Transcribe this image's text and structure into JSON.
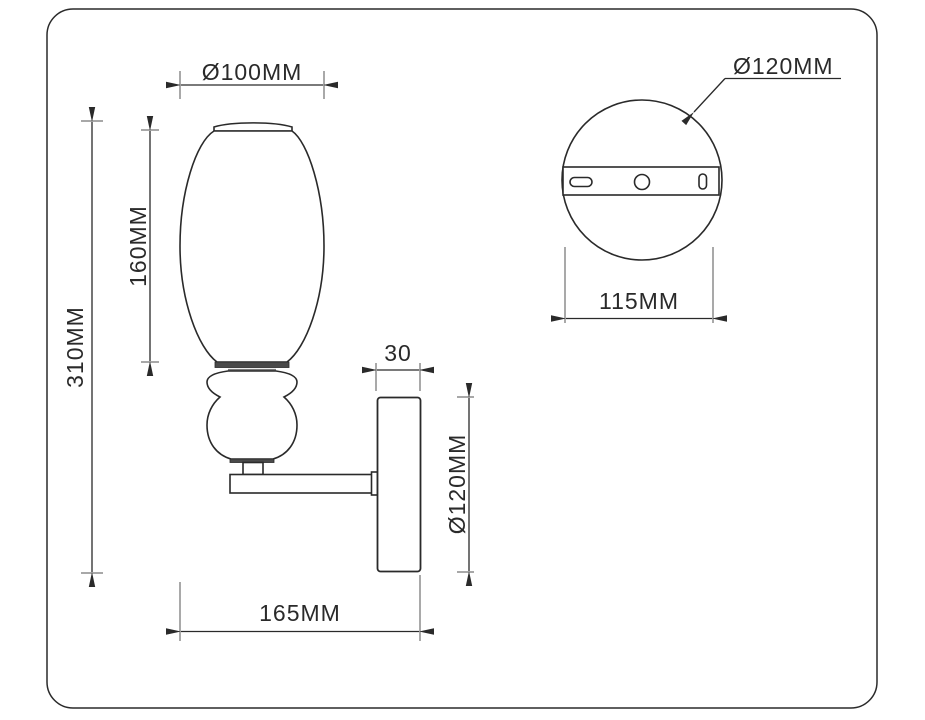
{
  "colors": {
    "line": "#2a2a2a",
    "extension_line": "#8c8c8c",
    "background": "#ffffff"
  },
  "side_view": {
    "shade_diameter_label": "Ø100MM",
    "shade_height_label": "160MM",
    "total_height_label": "310MM",
    "backplate_depth_label": "30",
    "backplate_diameter_label": "Ø120MM",
    "total_depth_label": "165MM"
  },
  "back_view": {
    "backplate_diameter_label": "Ø120MM",
    "mounting_width_label": "115MM"
  }
}
